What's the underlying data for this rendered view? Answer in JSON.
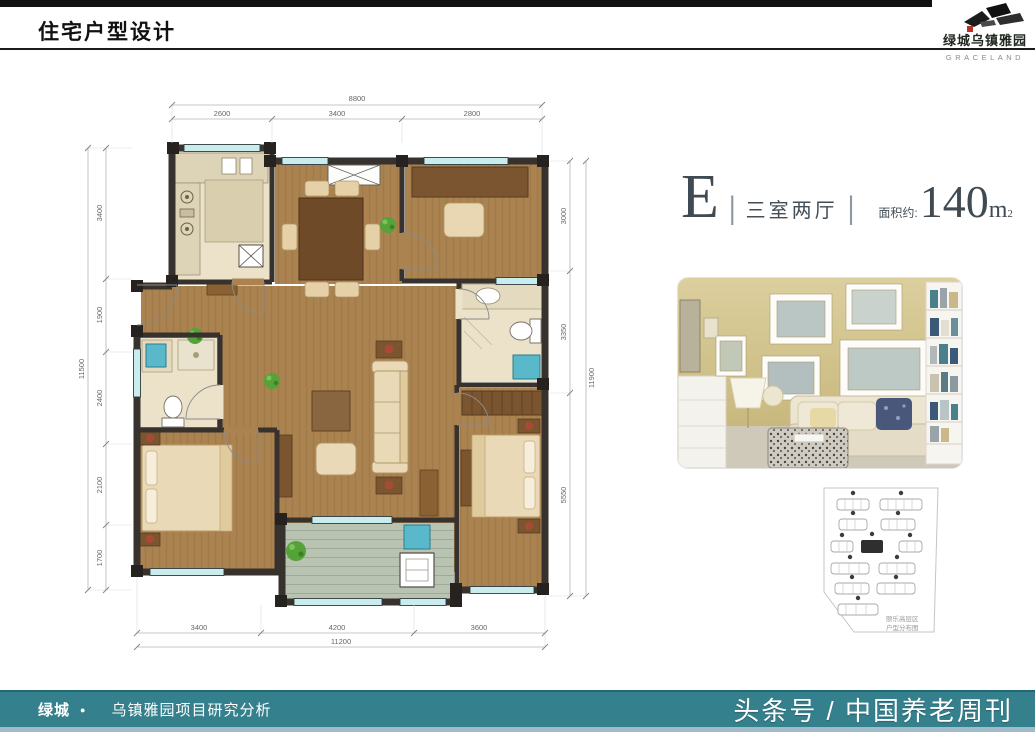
{
  "header": {
    "title": "住宅户型设计"
  },
  "logo": {
    "brand": "绿城乌镇雅园",
    "sub": "GRACELAND"
  },
  "unit": {
    "letter": "E",
    "sep": "|",
    "layout": "三室两厅",
    "area_label": "面积约:",
    "area_value": "140",
    "area_unit": "m",
    "area_exp": "2"
  },
  "floorplan": {
    "dims_top": {
      "overall": "8800",
      "segments": [
        "2600",
        "3400",
        "2800"
      ]
    },
    "dims_left": {
      "overall": "11500",
      "segments": [
        "3400",
        "1900",
        "2400",
        "2100",
        "1700"
      ]
    },
    "dims_right": {
      "overall": "11900",
      "segments": [
        "3000",
        "3350",
        "5550"
      ]
    },
    "dims_bottom": {
      "overall": "11200",
      "segments": [
        "3400",
        "4200",
        "3600"
      ]
    }
  },
  "siteplan": {
    "caption": [
      "颐乐高层区",
      "户型分布图"
    ]
  },
  "footer": {
    "brand": "绿城",
    "bullet": "●",
    "project": "乌镇雅园项目研究分析",
    "right": "头条号 / 中国养老周刊"
  },
  "colors": {
    "teal_bar": "#35808d",
    "wall": "#38322e",
    "floor_wood": "#ab8351",
    "floor_tile": "#ece2c9",
    "floor_balcony": "#b9c3b2",
    "window": "#c9ecec",
    "furniture_dark": "#6f4a28",
    "furniture_cream": "#ead9b6",
    "plant_green": "#55a238",
    "accent_red": "#a84b35",
    "title_slate": "#3f4a52"
  }
}
